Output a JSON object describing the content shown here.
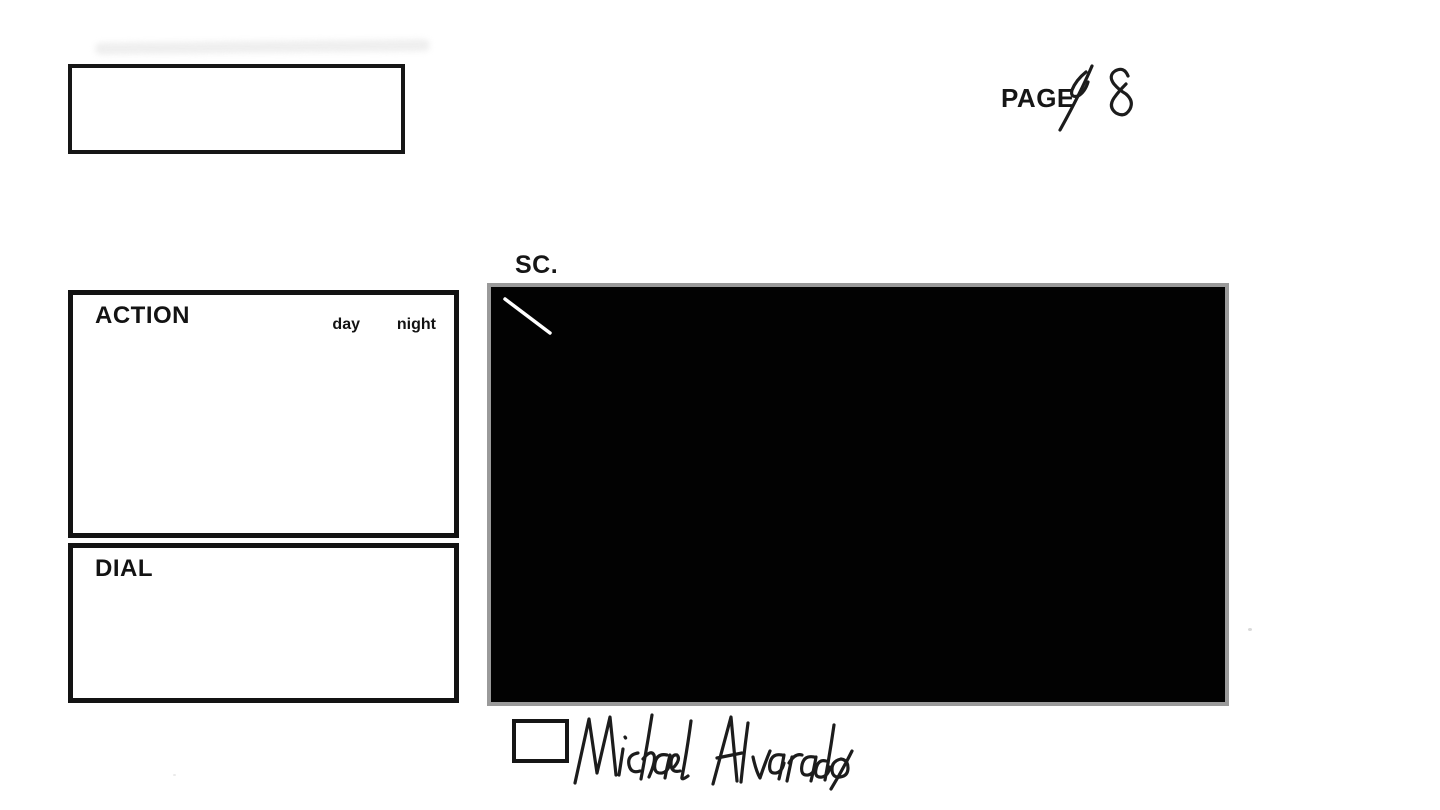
{
  "document": {
    "type": "storyboard-production-sheet",
    "background_color": "#ffffff",
    "ink_color": "#161616"
  },
  "header": {
    "page_label": "PAGE",
    "page_number_handwritten": "48"
  },
  "production_box": {
    "content": ""
  },
  "scene": {
    "label": "SC.",
    "number": "",
    "frame": {
      "fill_color": "#020202",
      "border_color": "#9a9a9a",
      "content": "blacked-out panel with small white diagonal scratch at top-left"
    }
  },
  "action_panel": {
    "label": "ACTION",
    "day_label": "day",
    "night_label": "night",
    "content": ""
  },
  "dial_panel": {
    "label": "DIAL",
    "content": ""
  },
  "signature_row": {
    "checkbox_checked": false,
    "signature_name": "Michael Alvarado"
  }
}
